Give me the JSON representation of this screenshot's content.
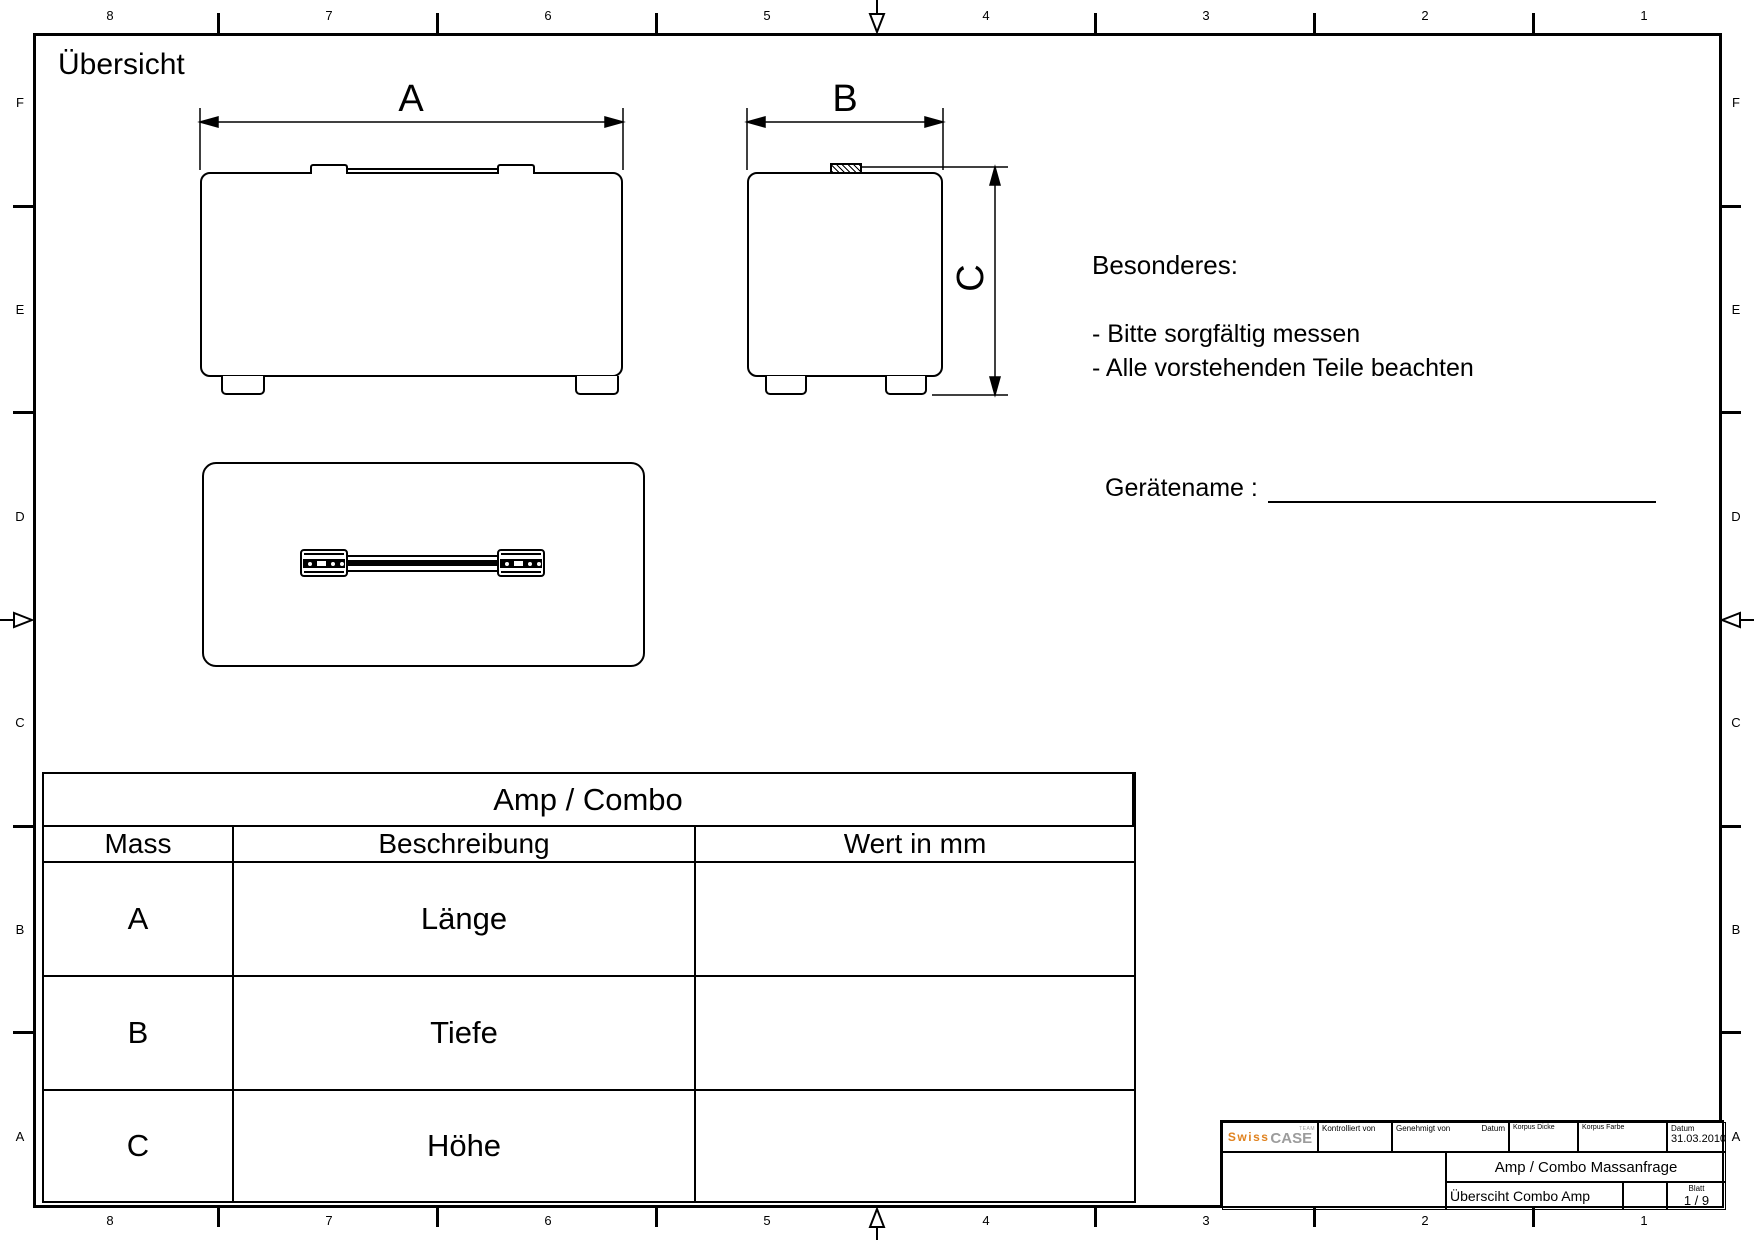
{
  "sheet": {
    "title": "Übersicht"
  },
  "border": {
    "top_numbers": [
      "8",
      "7",
      "6",
      "5",
      "4",
      "3",
      "2",
      "1"
    ],
    "bottom_numbers": [
      "8",
      "7",
      "6",
      "5",
      "4",
      "3",
      "2",
      "1"
    ],
    "left_letters": [
      "F",
      "E",
      "D",
      "C",
      "B",
      "A"
    ],
    "right_letters": [
      "F",
      "E",
      "D",
      "C",
      "B",
      "A"
    ]
  },
  "dimensions": {
    "a": "A",
    "b": "B",
    "c": "C"
  },
  "notes": {
    "heading": "Besonderes:",
    "items": [
      "- Bitte sorgfältig messen",
      "- Alle vorstehenden Teile beachten"
    ]
  },
  "device_name": {
    "label": "Gerätename :",
    "value": ""
  },
  "table": {
    "title": "Amp / Combo",
    "columns": [
      "Mass",
      "Beschreibung",
      "Wert in mm"
    ],
    "rows": [
      {
        "mass": "A",
        "beschreibung": "Länge",
        "wert": ""
      },
      {
        "mass": "B",
        "beschreibung": "Tiefe",
        "wert": ""
      },
      {
        "mass": "C",
        "beschreibung": "Höhe",
        "wert": ""
      }
    ]
  },
  "title_block": {
    "logo_swiss": "Swiss",
    "logo_case": "CASE",
    "logo_team": "TEAM",
    "kontrolliert_von_label": "Kontrolliert von",
    "genehmigt_von_label": "Genehmigt von",
    "datum_label": "Datum",
    "korpus_dicke_label": "Korpus Dicke",
    "korpus_farbe_label": "Korpus Farbe",
    "datum2_label": "Datum",
    "datum_value": "31.03.2010",
    "doc_title": "Amp / Combo Massanfrage",
    "sheet_name": "Übersciht Combo Amp",
    "blatt_label": "Blatt",
    "blatt_value": "1 / 9"
  },
  "colors": {
    "line": "#000000",
    "logo_orange": "#E0821E",
    "logo_gray": "#9C9C9C",
    "background": "#FFFFFF"
  }
}
